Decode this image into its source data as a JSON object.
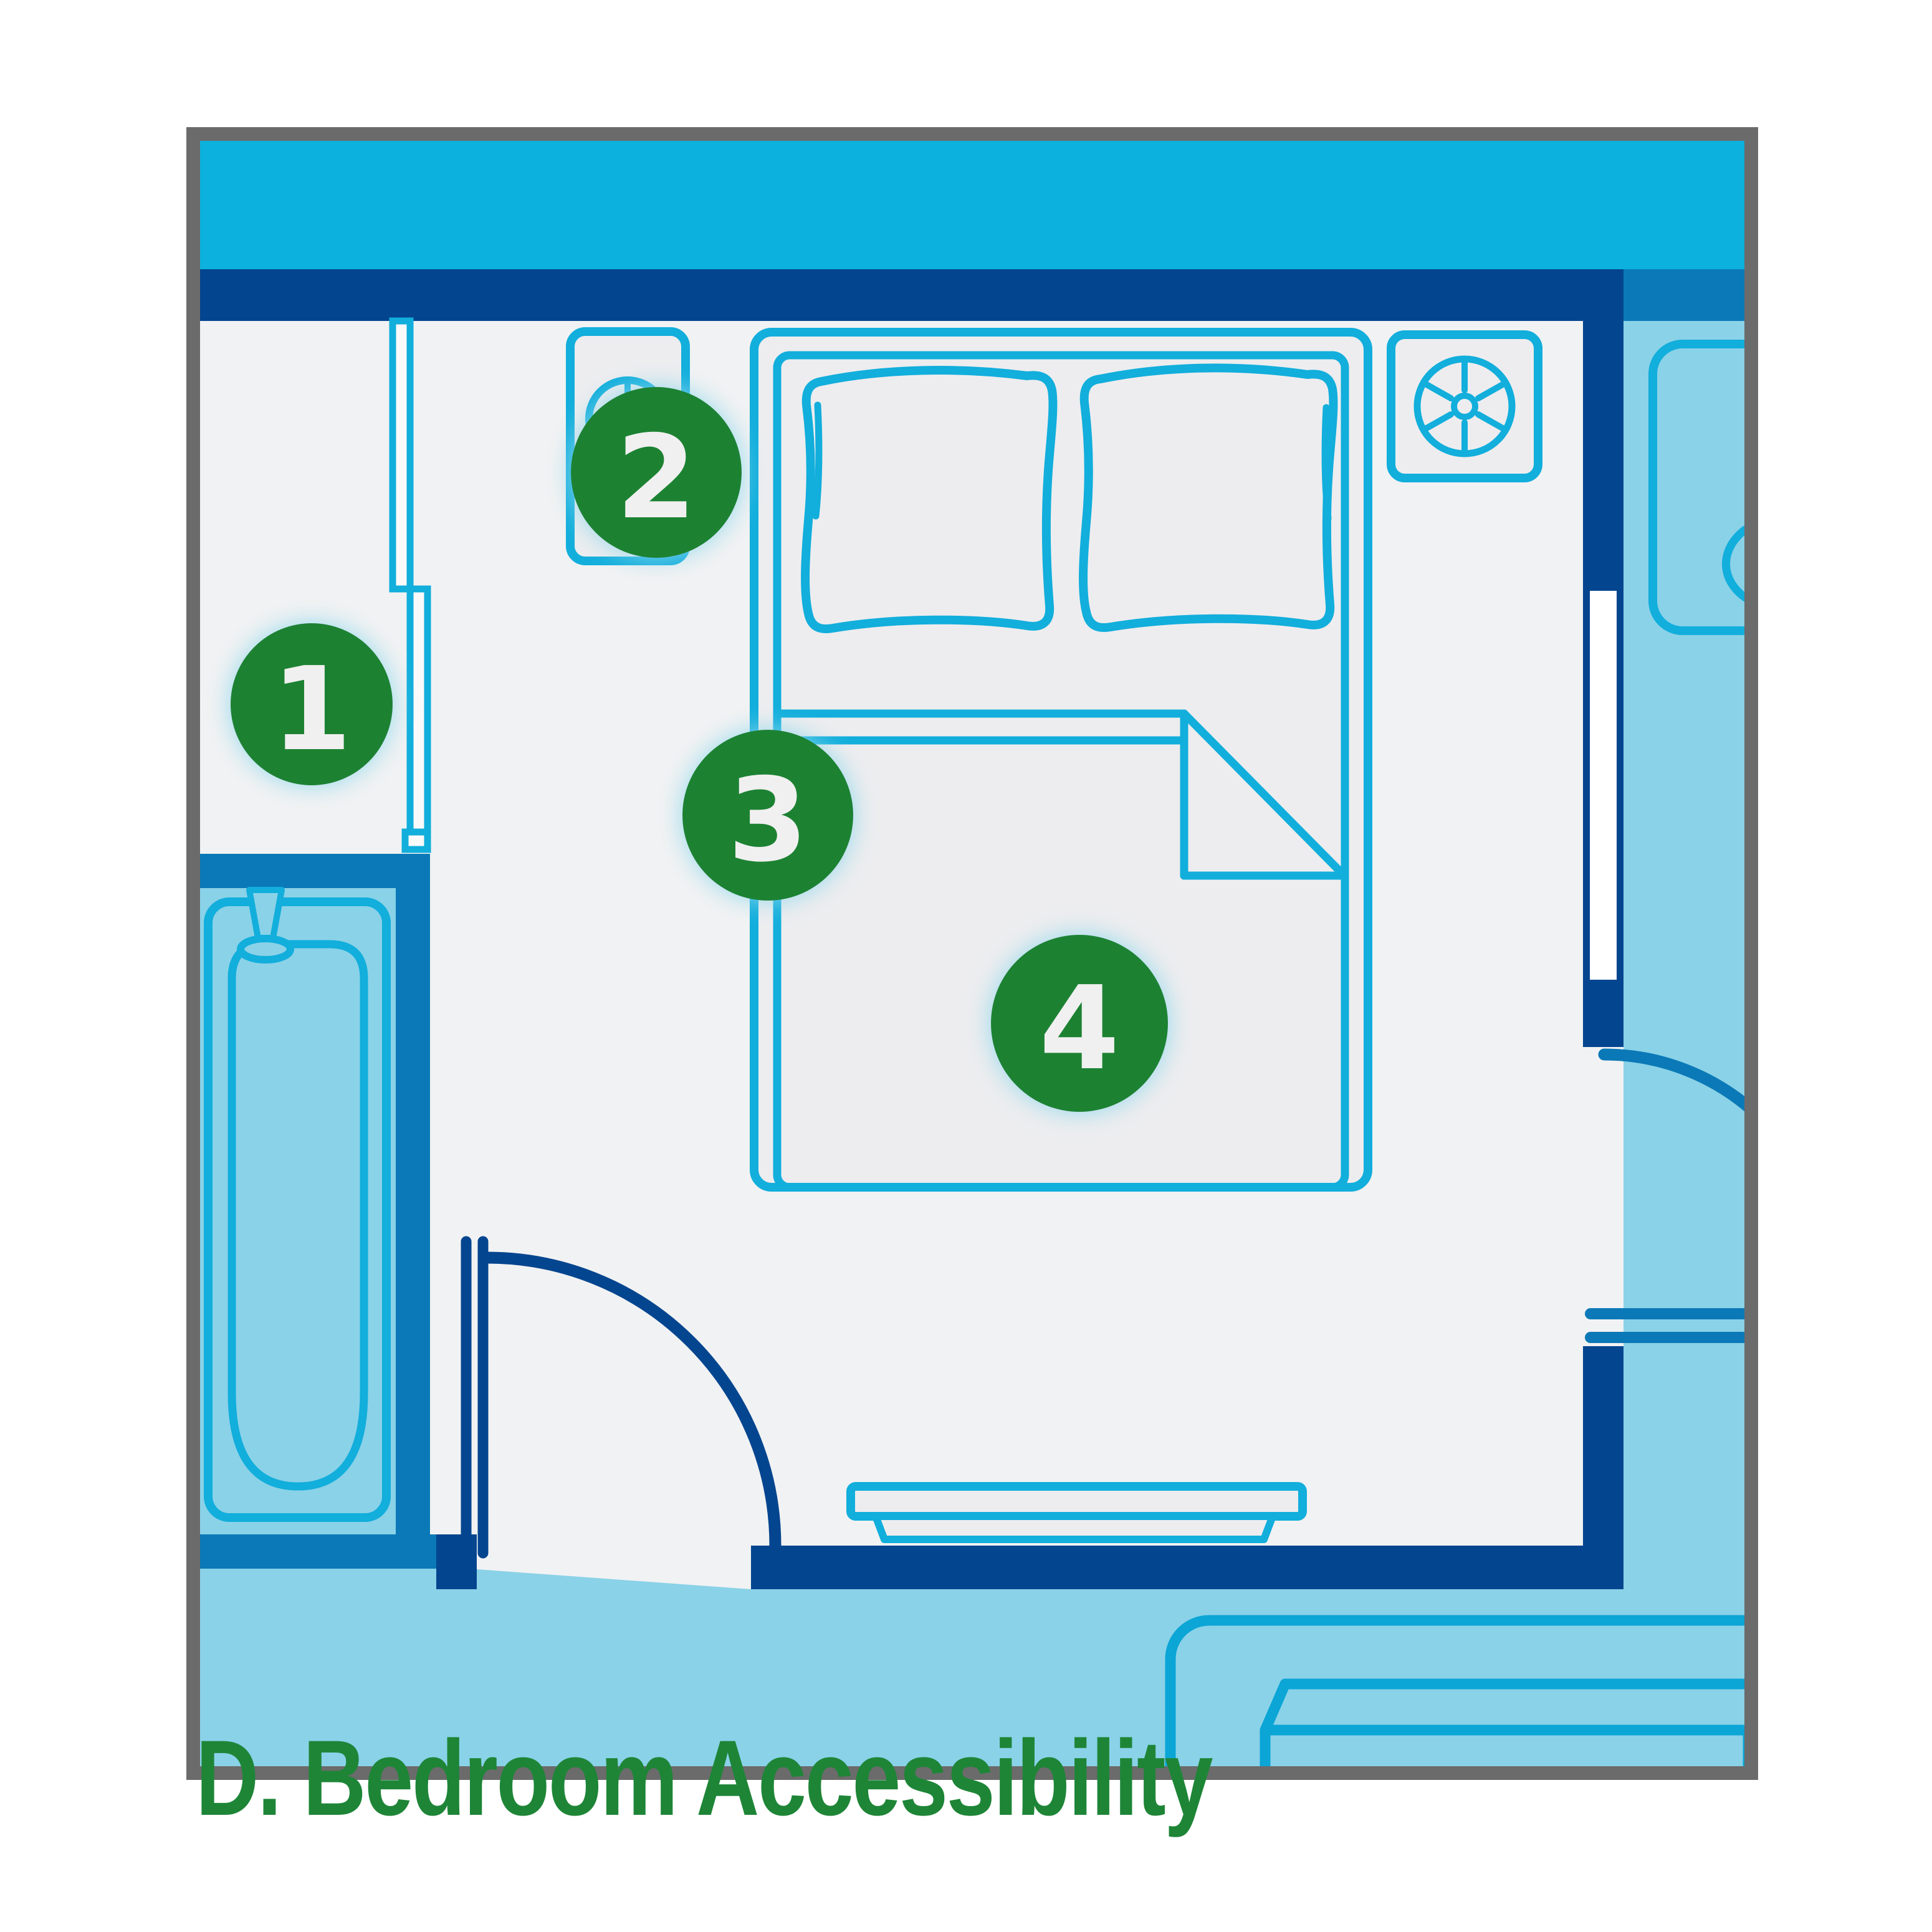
{
  "title": {
    "text": "D. Bedroom Accessibility"
  },
  "markers": [
    {
      "number": "1"
    },
    {
      "number": "2"
    },
    {
      "number": "3"
    },
    {
      "number": "4"
    }
  ],
  "icons": {
    "ceiling_fan": "fan-top-view",
    "lamp": "lamp-top-view",
    "bathtub": "bathtub-top-view",
    "bed": "double-bed-top-view"
  },
  "colors": {
    "frame": "#6B6B6B",
    "band_cyan": "#0CB1DD",
    "wall_navy": "#04458F",
    "wall_blue": "#0B79B7",
    "light_blue": "#8AD2E8",
    "outline_cyan": "#12AEDC",
    "rug_blue": "#0BA5D6",
    "floor": "#F1F2F3",
    "furniture": "#EDEDEF",
    "window_white": "#FFFFFF",
    "door_white": "#FAFAFA",
    "marker_green": "#1F8233",
    "number_white": "#F0F0F0",
    "title_green": "#1E8537",
    "glow_cyan": "#8FD8EC"
  }
}
